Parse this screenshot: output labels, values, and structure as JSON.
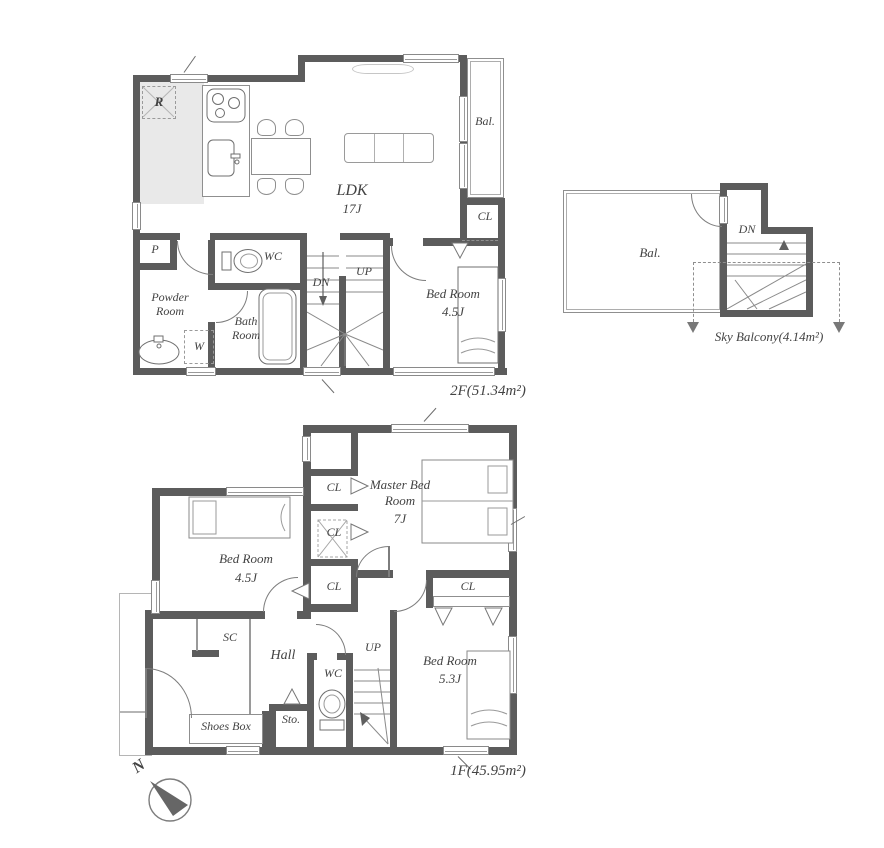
{
  "floor2": {
    "area_label": "2F(51.34m²)",
    "ldk": "LDK",
    "ldk_size": "17J",
    "balcony": "Bal.",
    "closet": "CL",
    "wc": "WC",
    "down": "DN",
    "up": "UP",
    "bedroom": "Bed Room",
    "bedroom_size": "4.5J",
    "powder_room": "Powder Room",
    "bath_room": "Bath Room",
    "pantry": "P",
    "washer": "W",
    "fridge": "R"
  },
  "sky": {
    "area_label": "Sky Balcony(4.14m²)",
    "balcony": "Bal.",
    "down": "DN"
  },
  "floor1": {
    "area_label": "1F(45.95m²)",
    "master_bedroom": "Master Bed Room",
    "master_size": "7J",
    "closet": "CL",
    "bedroom_a": "Bed Room",
    "bedroom_a_size": "4.5J",
    "bedroom_b": "Bed Room",
    "bedroom_b_size": "5.3J",
    "shoe_closet": "SC",
    "hall": "Hall",
    "up": "UP",
    "wc": "WC",
    "storage": "Sto.",
    "shoes_box": "Shoes Box"
  },
  "compass": {
    "north": "N"
  }
}
